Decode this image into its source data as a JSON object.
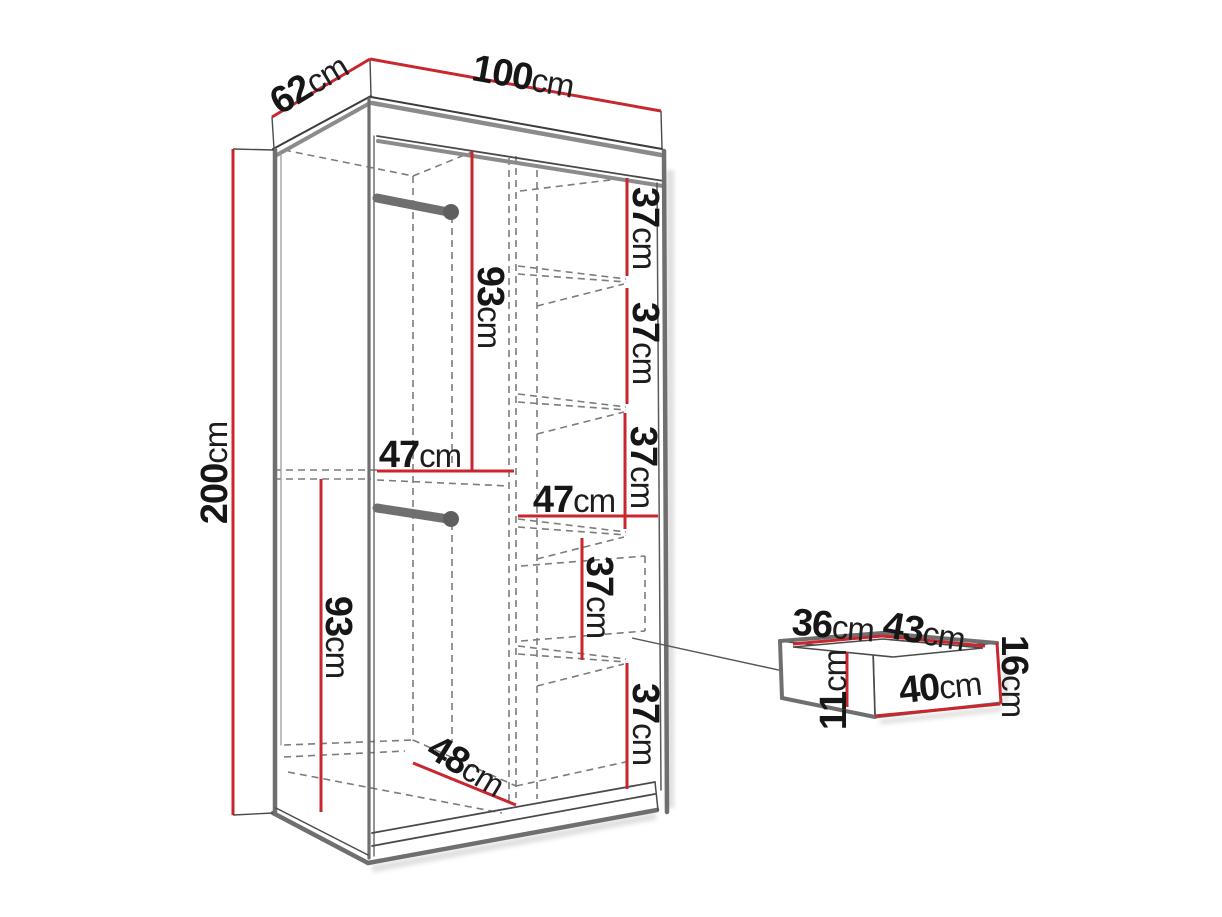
{
  "figure": {
    "type": "furniture-dimension-diagram",
    "subject": "two-compartment wardrobe with shelves, two hanging rods and a separate drawer box",
    "background": "#ffffff"
  },
  "colors": {
    "dimension_red": "#c9262e",
    "edge_gray": "#707070",
    "edge_shadow_gray": "#8b8b8b",
    "thin_line": "#3c3c3c",
    "dashed_gray": "#7c7c7c",
    "text": "#161616"
  },
  "labels": {
    "depth_62": {
      "num": "62",
      "unit": "cm"
    },
    "width_100": {
      "num": "100",
      "unit": "cm"
    },
    "height_200": {
      "num": "200",
      "unit": "cm"
    },
    "upper_rod_93": {
      "num": "93",
      "unit": "cm"
    },
    "left_width_47": {
      "num": "47",
      "unit": "cm"
    },
    "lower_rod_93": {
      "num": "93",
      "unit": "cm"
    },
    "right_width_47": {
      "num": "47",
      "unit": "cm"
    },
    "floor_depth_48": {
      "num": "48",
      "unit": "cm"
    },
    "shelf1_37": {
      "num": "37",
      "unit": "cm"
    },
    "shelf2_37": {
      "num": "37",
      "unit": "cm"
    },
    "shelf3_37": {
      "num": "37",
      "unit": "cm"
    },
    "shelf4_37": {
      "num": "37",
      "unit": "cm"
    },
    "shelf5_37": {
      "num": "37",
      "unit": "cm"
    },
    "drawer_depth_36": {
      "num": "36",
      "unit": "cm"
    },
    "drawer_width_43": {
      "num": "43",
      "unit": "cm"
    },
    "drawer_height_16": {
      "num": "16",
      "unit": "cm"
    },
    "drawer_inner_11": {
      "num": "11",
      "unit": "cm"
    },
    "drawer_front_40": {
      "num": "40",
      "unit": "cm"
    }
  }
}
